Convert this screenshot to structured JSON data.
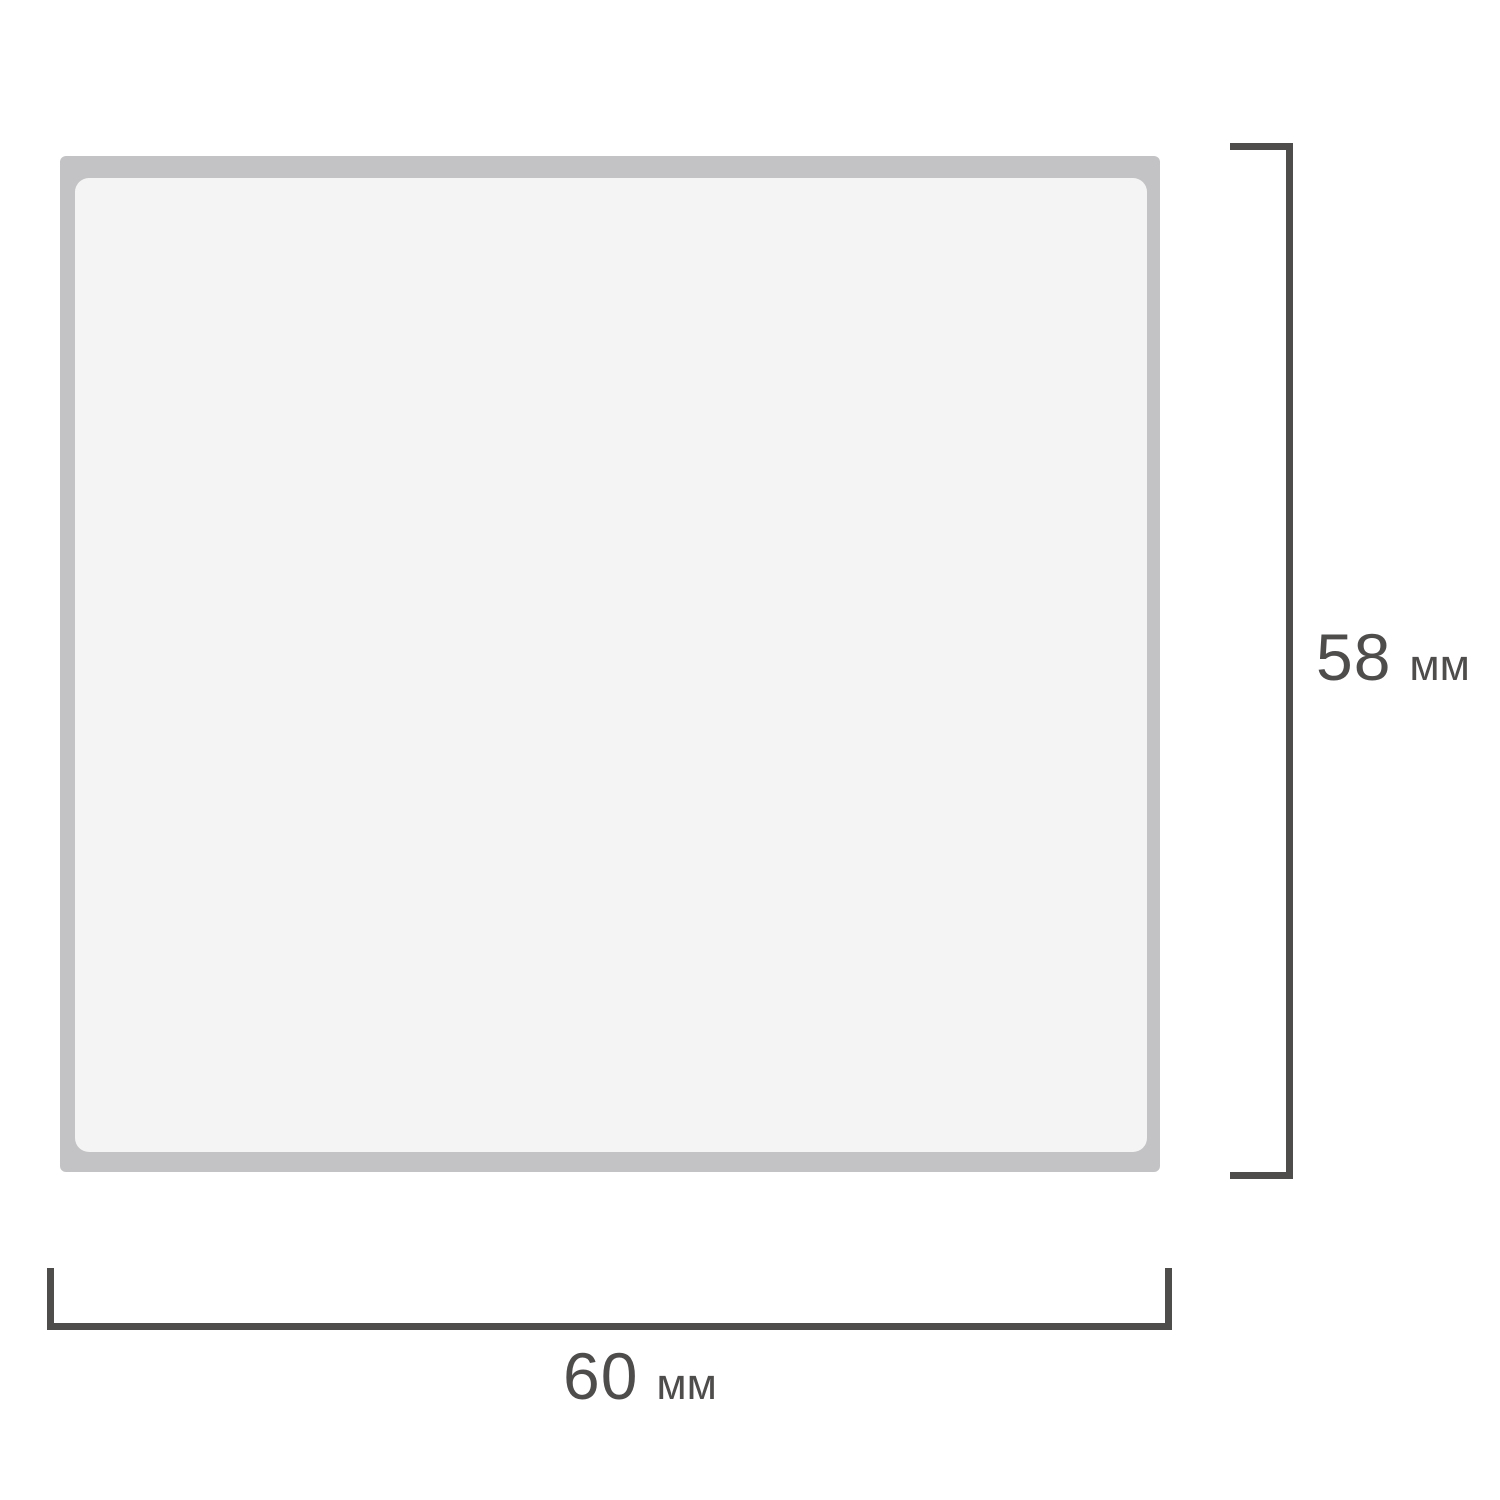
{
  "diagram": {
    "kind": "product-dimension-drawing",
    "height_dimension": {
      "value": "58",
      "unit": "мм"
    },
    "width_dimension": {
      "value": "60",
      "unit": "мм"
    },
    "colors": {
      "product_edge": "#c3c3c5",
      "product_face": "#f4f4f5",
      "dimension_lines_and_text": "#4f4c4c",
      "background": "#ffffff"
    }
  }
}
